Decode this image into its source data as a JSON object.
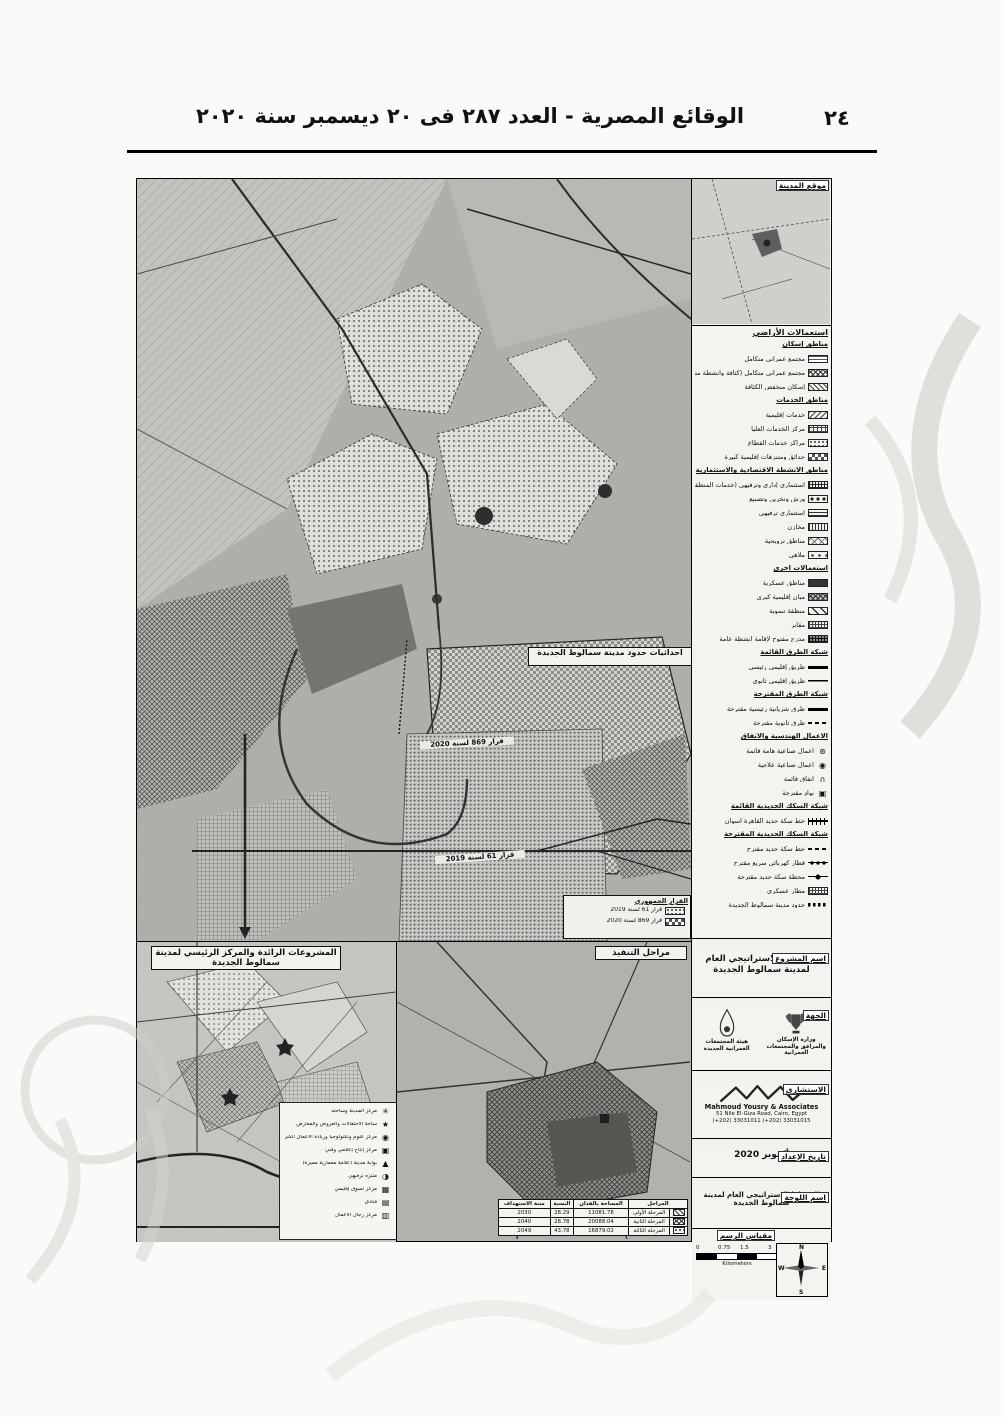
{
  "page": {
    "number": "٢٤",
    "header_title": "الوقائع المصرية - العدد ٢٨٧ فى ٢٠ ديسمبر سنة ٢٠٢٠"
  },
  "inset": {
    "title": "موقع المدينة"
  },
  "legend": {
    "title": "استعمالات الأراضي",
    "entries": [
      {
        "cls": "lg-h",
        "sw": "sw-none",
        "label": "مناطق إسكان"
      },
      {
        "cls": "lg-i",
        "sw": "sw-brick",
        "label": "مجتمع عمراني متكامل"
      },
      {
        "cls": "lg-i",
        "sw": "sw-cross",
        "label": "مجتمع عمراني متكامل (كثافة وأنشطة متعددة الاستخدامات)"
      },
      {
        "cls": "lg-i",
        "sw": "sw-diag",
        "label": "إسكان منخفض الكثافة"
      },
      {
        "cls": "lg-h",
        "sw": "sw-none",
        "label": "مناطق الخدمات"
      },
      {
        "cls": "lg-i",
        "sw": "sw-diag2",
        "label": "خدمات إقليمية"
      },
      {
        "cls": "lg-i",
        "sw": "sw-grid",
        "label": "مركز الخدمات العليا"
      },
      {
        "cls": "lg-i",
        "sw": "sw-dots",
        "label": "مراكز خدمات القطاع"
      },
      {
        "cls": "lg-i",
        "sw": "sw-checker",
        "label": "حدائق ومتنزهات إقليمية كبيرة"
      },
      {
        "cls": "lg-h",
        "sw": "sw-none",
        "label": "مناطق الأنشطة الاقتصادية والاستثمارية"
      },
      {
        "cls": "lg-i",
        "sw": "sw-gridd",
        "label": "استثماري إداري وترفيهي (خدمات المنطقة المركزية)"
      },
      {
        "cls": "lg-i",
        "sw": "sw-dotsbig",
        "label": "ورش وتخزين وتصنيع"
      },
      {
        "cls": "lg-i",
        "sw": "sw-hlines",
        "label": "استثماري ترفيهي"
      },
      {
        "cls": "lg-i",
        "sw": "sw-vlines",
        "label": "مخازن"
      },
      {
        "cls": "lg-i",
        "sw": "sw-cross2",
        "label": "مناطق ترويحية"
      },
      {
        "cls": "lg-i",
        "sw": "sw-dotsp",
        "label": "ملاهي"
      },
      {
        "cls": "lg-h",
        "sw": "sw-none",
        "label": "استعمالات أخرى"
      },
      {
        "cls": "lg-i",
        "sw": "sw-dark",
        "label": "مناطق عسكرية"
      },
      {
        "cls": "lg-i",
        "sw": "sw-crossd",
        "label": "مبانٍ إقليمية كبرى"
      },
      {
        "cls": "lg-i",
        "sw": "sw-diagw",
        "label": "منطقة تنموية"
      },
      {
        "cls": "lg-i",
        "sw": "sw-gridt",
        "label": "مقابر"
      },
      {
        "cls": "lg-i",
        "sw": "sw-gridk",
        "label": "مدرج مفتوح لإقامة أنشطة عامة"
      },
      {
        "cls": "lg-h",
        "sw": "sw-none",
        "label": "شبكة الطرق القائمة"
      },
      {
        "cls": "lg-i",
        "sw": "sw-lthick",
        "label": "طريق إقليمي رئيسي"
      },
      {
        "cls": "lg-i",
        "sw": "sw-lthin",
        "label": "طريق إقليمي ثانوي"
      },
      {
        "cls": "lg-h",
        "sw": "sw-none",
        "label": "شبكة الطرق المقترحة"
      },
      {
        "cls": "lg-i",
        "sw": "sw-lthick2",
        "label": "طرق شريانية رئيسية مقترحة"
      },
      {
        "cls": "lg-i",
        "sw": "sw-ldash",
        "label": "طرق ثانوية مقترحة"
      },
      {
        "cls": "lg-h",
        "sw": "sw-none",
        "label": "الأعمال الهندسية والأنفاق"
      },
      {
        "cls": "lg-i",
        "sw": "sw-none",
        "icon": "⊛",
        "label": "أعمال صناعية هامة قائمة"
      },
      {
        "cls": "lg-i",
        "sw": "sw-none",
        "icon": "◉",
        "label": "أعمال صناعية علاجية"
      },
      {
        "cls": "lg-i",
        "sw": "sw-none",
        "icon": "∩",
        "label": "أنفاق قائمة"
      },
      {
        "cls": "lg-i",
        "sw": "sw-none",
        "icon": "▣",
        "label": "نوادٍ مقترحة"
      },
      {
        "cls": "lg-h",
        "sw": "sw-none",
        "label": "شبكة السكك الحديدية القائمة"
      },
      {
        "cls": "lg-i",
        "sw": "sw-rail",
        "label": "خط سكة حديد القاهرة أسوان"
      },
      {
        "cls": "lg-h",
        "sw": "sw-none",
        "label": "شبكة السكك الحديدية المقترحة"
      },
      {
        "cls": "lg-i",
        "sw": "sw-raildash",
        "label": "خط سكة حديد مقترح"
      },
      {
        "cls": "lg-i",
        "sw": "sw-circles",
        "label": "قطار كهربائي سريع مقترح"
      },
      {
        "cls": "lg-i",
        "sw": "sw-ldot",
        "label": "محطة سكة حديد مقترحة"
      },
      {
        "cls": "lg-i",
        "sw": "sw-gridt",
        "label": "مطار عسكري"
      },
      {
        "cls": "lg-i",
        "sw": "sw-boundary",
        "label": "حدود مدينة سمالوط الجديدة"
      }
    ]
  },
  "map_labels": {
    "coords_box": "احداثيات حدود مدينة سمالوط الجديدة",
    "decree_869": "قرار 869 لسنة 2020",
    "decree_61": "قرار 61 لسنة 2019",
    "decree_box_title": "القرار الجمهوري",
    "decree_box_rows": [
      {
        "sw": "sw-dots",
        "label": "قرار 61 لسنة 2019"
      },
      {
        "sw": "sw-checker",
        "label": "قرار 869 لسنة 2020"
      }
    ]
  },
  "panel_left": {
    "title": "المشروعات الرائدة والمركز الرئيسي لمدينة سمالوط الجديدة",
    "legend": [
      {
        "icon": "✳",
        "label": "مركز المدينة وساحته"
      },
      {
        "icon": "★",
        "label": "ساحة الاحتفالات والعروض والمعارض"
      },
      {
        "icon": "◉",
        "label": "مركز علوم وتكنولوجيا وريادة الأعمال الكبرى"
      },
      {
        "icon": "▣",
        "label": "مركز إنتاج إعلامي وفني"
      },
      {
        "icon": "▲",
        "label": "بوابة مدينة (علامة معمارية مميزة)"
      },
      {
        "icon": "◑",
        "label": "متنزه ترفيهي"
      },
      {
        "icon": "▦",
        "label": "مركز تسوق إقليمي"
      },
      {
        "icon": "▤",
        "label": "فنادق"
      },
      {
        "icon": "▥",
        "label": "مركز رجال الأعمال"
      }
    ]
  },
  "panel_mid": {
    "title": "مراحل التنفيذ",
    "table": {
      "headers": [
        "المراحل",
        "المساحة بالفدان",
        "النسبة",
        "سنة الاستهداف"
      ],
      "rows": [
        {
          "sw": "sw-diag",
          "name": "المرحلة الأولى",
          "area": "11081.78",
          "pct": "28.29",
          "year": "2030"
        },
        {
          "sw": "sw-cross",
          "name": "المرحلة الثانية",
          "area": "20088.04",
          "pct": "28.78",
          "year": "2040"
        },
        {
          "sw": "sw-dots",
          "name": "المرحلة الثالثة",
          "area": "16879.02",
          "pct": "43.78",
          "year": "2049"
        }
      ]
    }
  },
  "project": {
    "section_label": "اسم المشروع",
    "name": "المخطط الاستراتيجي العام لمدينة سمالوط الجديدة"
  },
  "agency": {
    "section_label": "الجهة",
    "logos": [
      {
        "caption": "وزارة الإسكان والمرافق والمجتمعات العمرانية"
      },
      {
        "caption": "هيئة المجتمعات العمرانية الجديدة"
      }
    ]
  },
  "consultant": {
    "section_label": "الاستشاري",
    "name": "Mahmoud Yousry & Associates",
    "address": "51 Nile El-Giza Road, Cairo, Egypt",
    "phone": "(+202) 33031011 (+202) 33031015"
  },
  "prepared": {
    "section_label": "تاريخ الإعداد",
    "value": "أكتوبر 2020"
  },
  "sheet": {
    "section_label": "اسم اللوحة",
    "value": "المخطط الاستراتيجي العام لمدينة سمالوط الجديدة"
  },
  "scale": {
    "section_label": "مقياس الرسم",
    "ticks": [
      "0",
      "0.75",
      "1.5",
      "3"
    ],
    "unit": "Kilometers",
    "compass": {
      "n": "N",
      "e": "E",
      "s": "S",
      "w": "W"
    }
  }
}
